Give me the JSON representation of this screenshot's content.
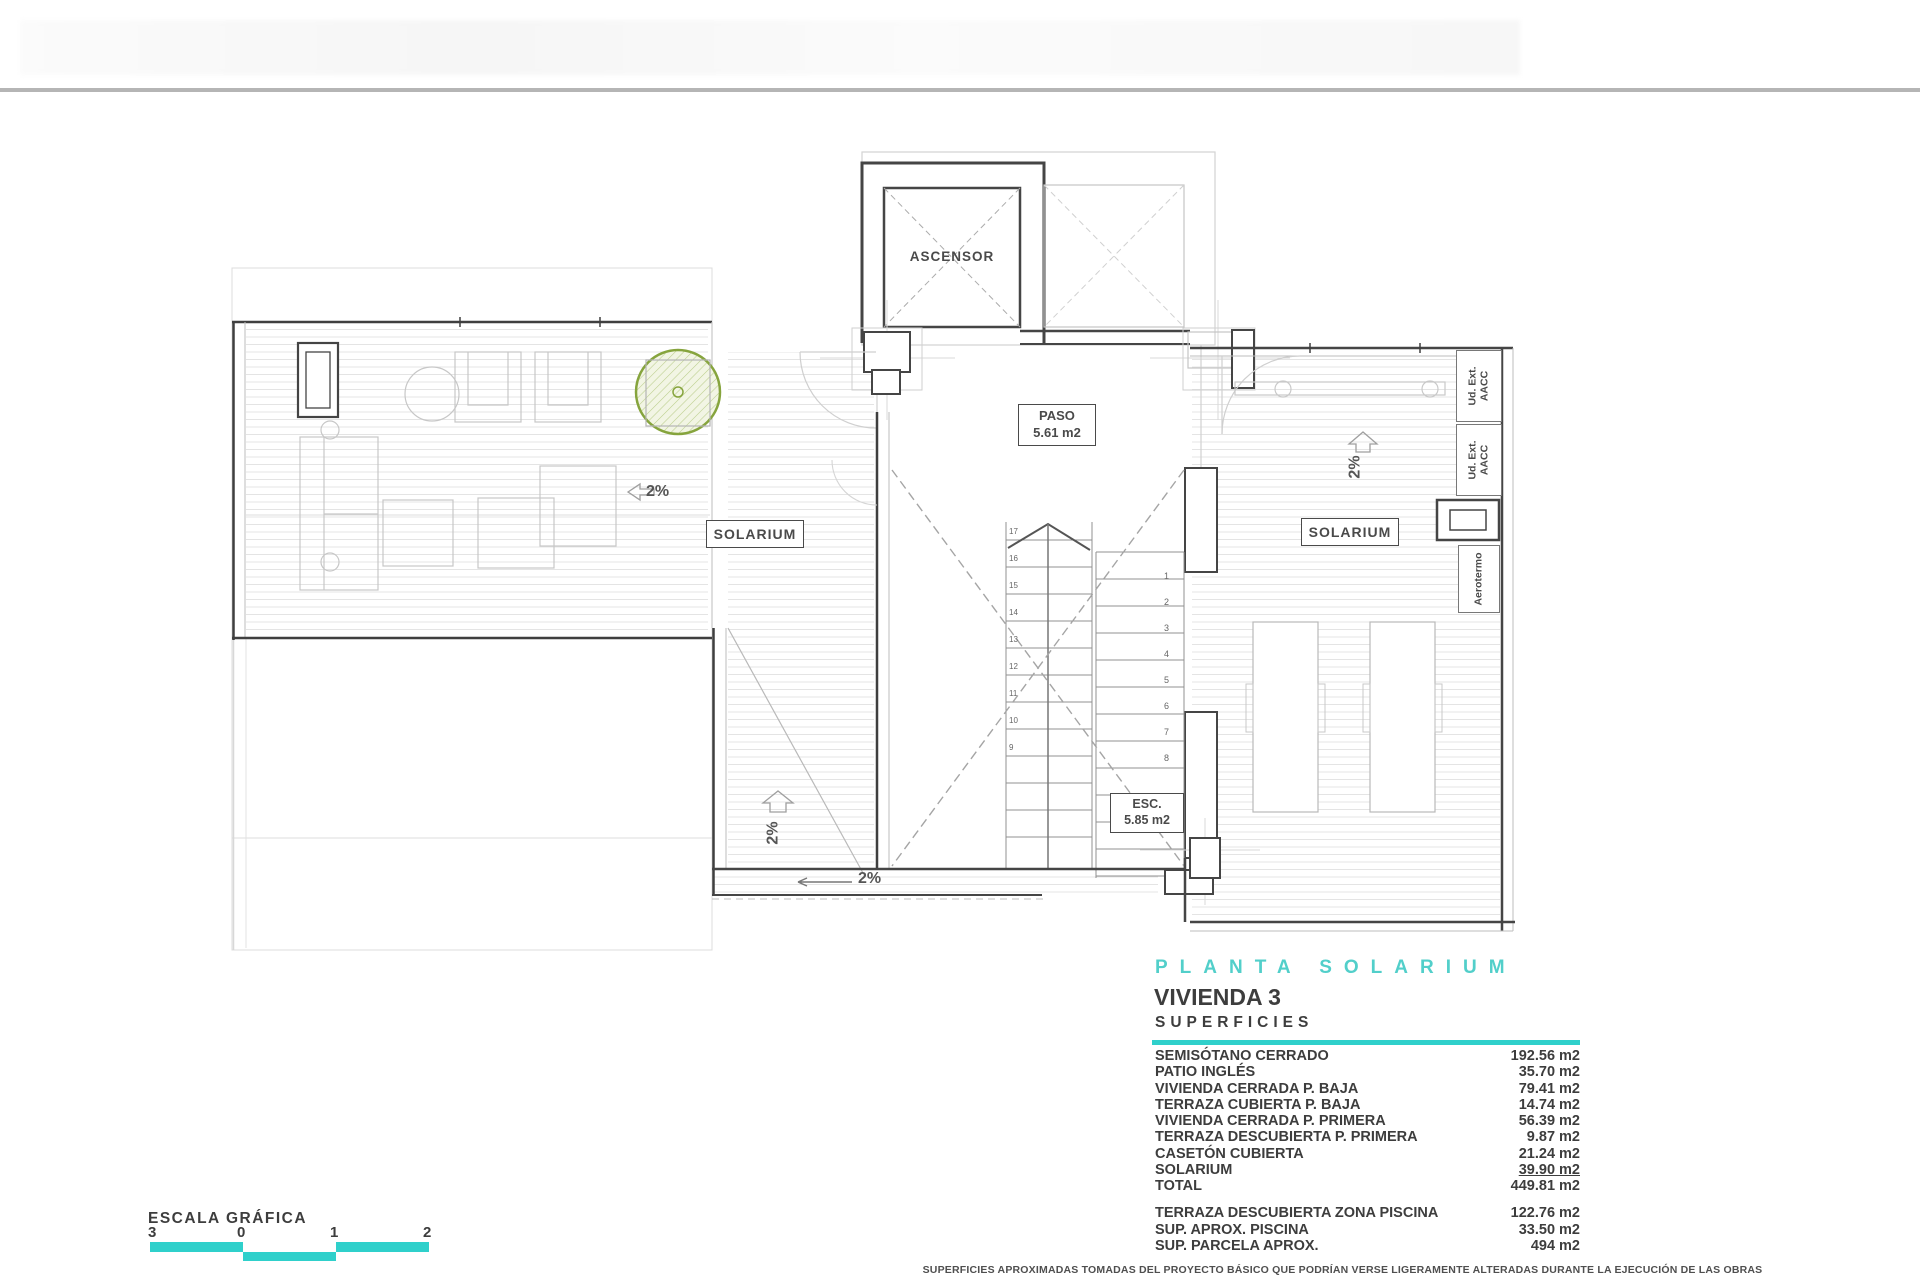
{
  "accent_teal": "#2fd0cb",
  "plan": {
    "labels": {
      "ascensor": "ASCENSOR",
      "paso_line1": "PASO",
      "paso_line2": "5.61 m2",
      "esc_line1": "ESC.",
      "esc_line2": "5.85 m2",
      "solarium_left": "SOLARIUM",
      "solarium_right": "SOLARIUM",
      "ud_ext_1": "Ud. Ext.\nAACC",
      "ud_ext_2": "Ud. Ext.\nAACC",
      "aerotermo": "Aerotermo",
      "slope_left": "2%",
      "slope_center": "2%",
      "slope_corridor": "2%",
      "slope_right": "2%"
    },
    "stair_numbers_left": [
      "17",
      "16",
      "15",
      "14",
      "13",
      "12",
      "11",
      "10",
      "9"
    ],
    "stair_numbers_right": [
      "1",
      "2",
      "3",
      "4",
      "5",
      "6",
      "7",
      "8"
    ]
  },
  "scale": {
    "title": "ESCALA GRÁFICA",
    "ticks": [
      "0",
      "1",
      "2",
      "3"
    ]
  },
  "titleblock": {
    "plan_name": "PLANTA SOLARIUM",
    "unit_name": "VIVIENDA 3",
    "section_title": "SUPERFICIES",
    "rows": [
      {
        "label": "SEMISÓTANO CERRADO",
        "value": "192.56 m2"
      },
      {
        "label": "PATIO INGLÉS",
        "value": "35.70 m2"
      },
      {
        "label": "VIVIENDA CERRADA P. BAJA",
        "value": "79.41 m2"
      },
      {
        "label": "TERRAZA CUBIERTA P. BAJA",
        "value": "14.74 m2"
      },
      {
        "label": "VIVIENDA CERRADA P. PRIMERA",
        "value": "56.39 m2"
      },
      {
        "label": "TERRAZA DESCUBIERTA P. PRIMERA",
        "value": "9.87 m2"
      },
      {
        "label": "CASETÓN CUBIERTA",
        "value": "21.24 m2"
      },
      {
        "label": "SOLARIUM",
        "value": "39.90 m2",
        "underline": true
      },
      {
        "label": "TOTAL",
        "value": "449.81 m2"
      }
    ],
    "extra_rows": [
      {
        "label": "TERRAZA DESCUBIERTA  ZONA PISCINA",
        "value": "122.76 m2"
      },
      {
        "label": "SUP.  APROX.  PISCINA",
        "value": "33.50 m2"
      },
      {
        "label": "SUP. PARCELA APROX.",
        "value": "494 m2"
      }
    ],
    "disclaimer": "SUPERFICIES APROXIMADAS TOMADAS DEL PROYECTO BÁSICO QUE PODRÍAN VERSE LIGERAMENTE ALTERADAS DURANTE LA EJECUCIÓN DE LAS OBRAS"
  }
}
